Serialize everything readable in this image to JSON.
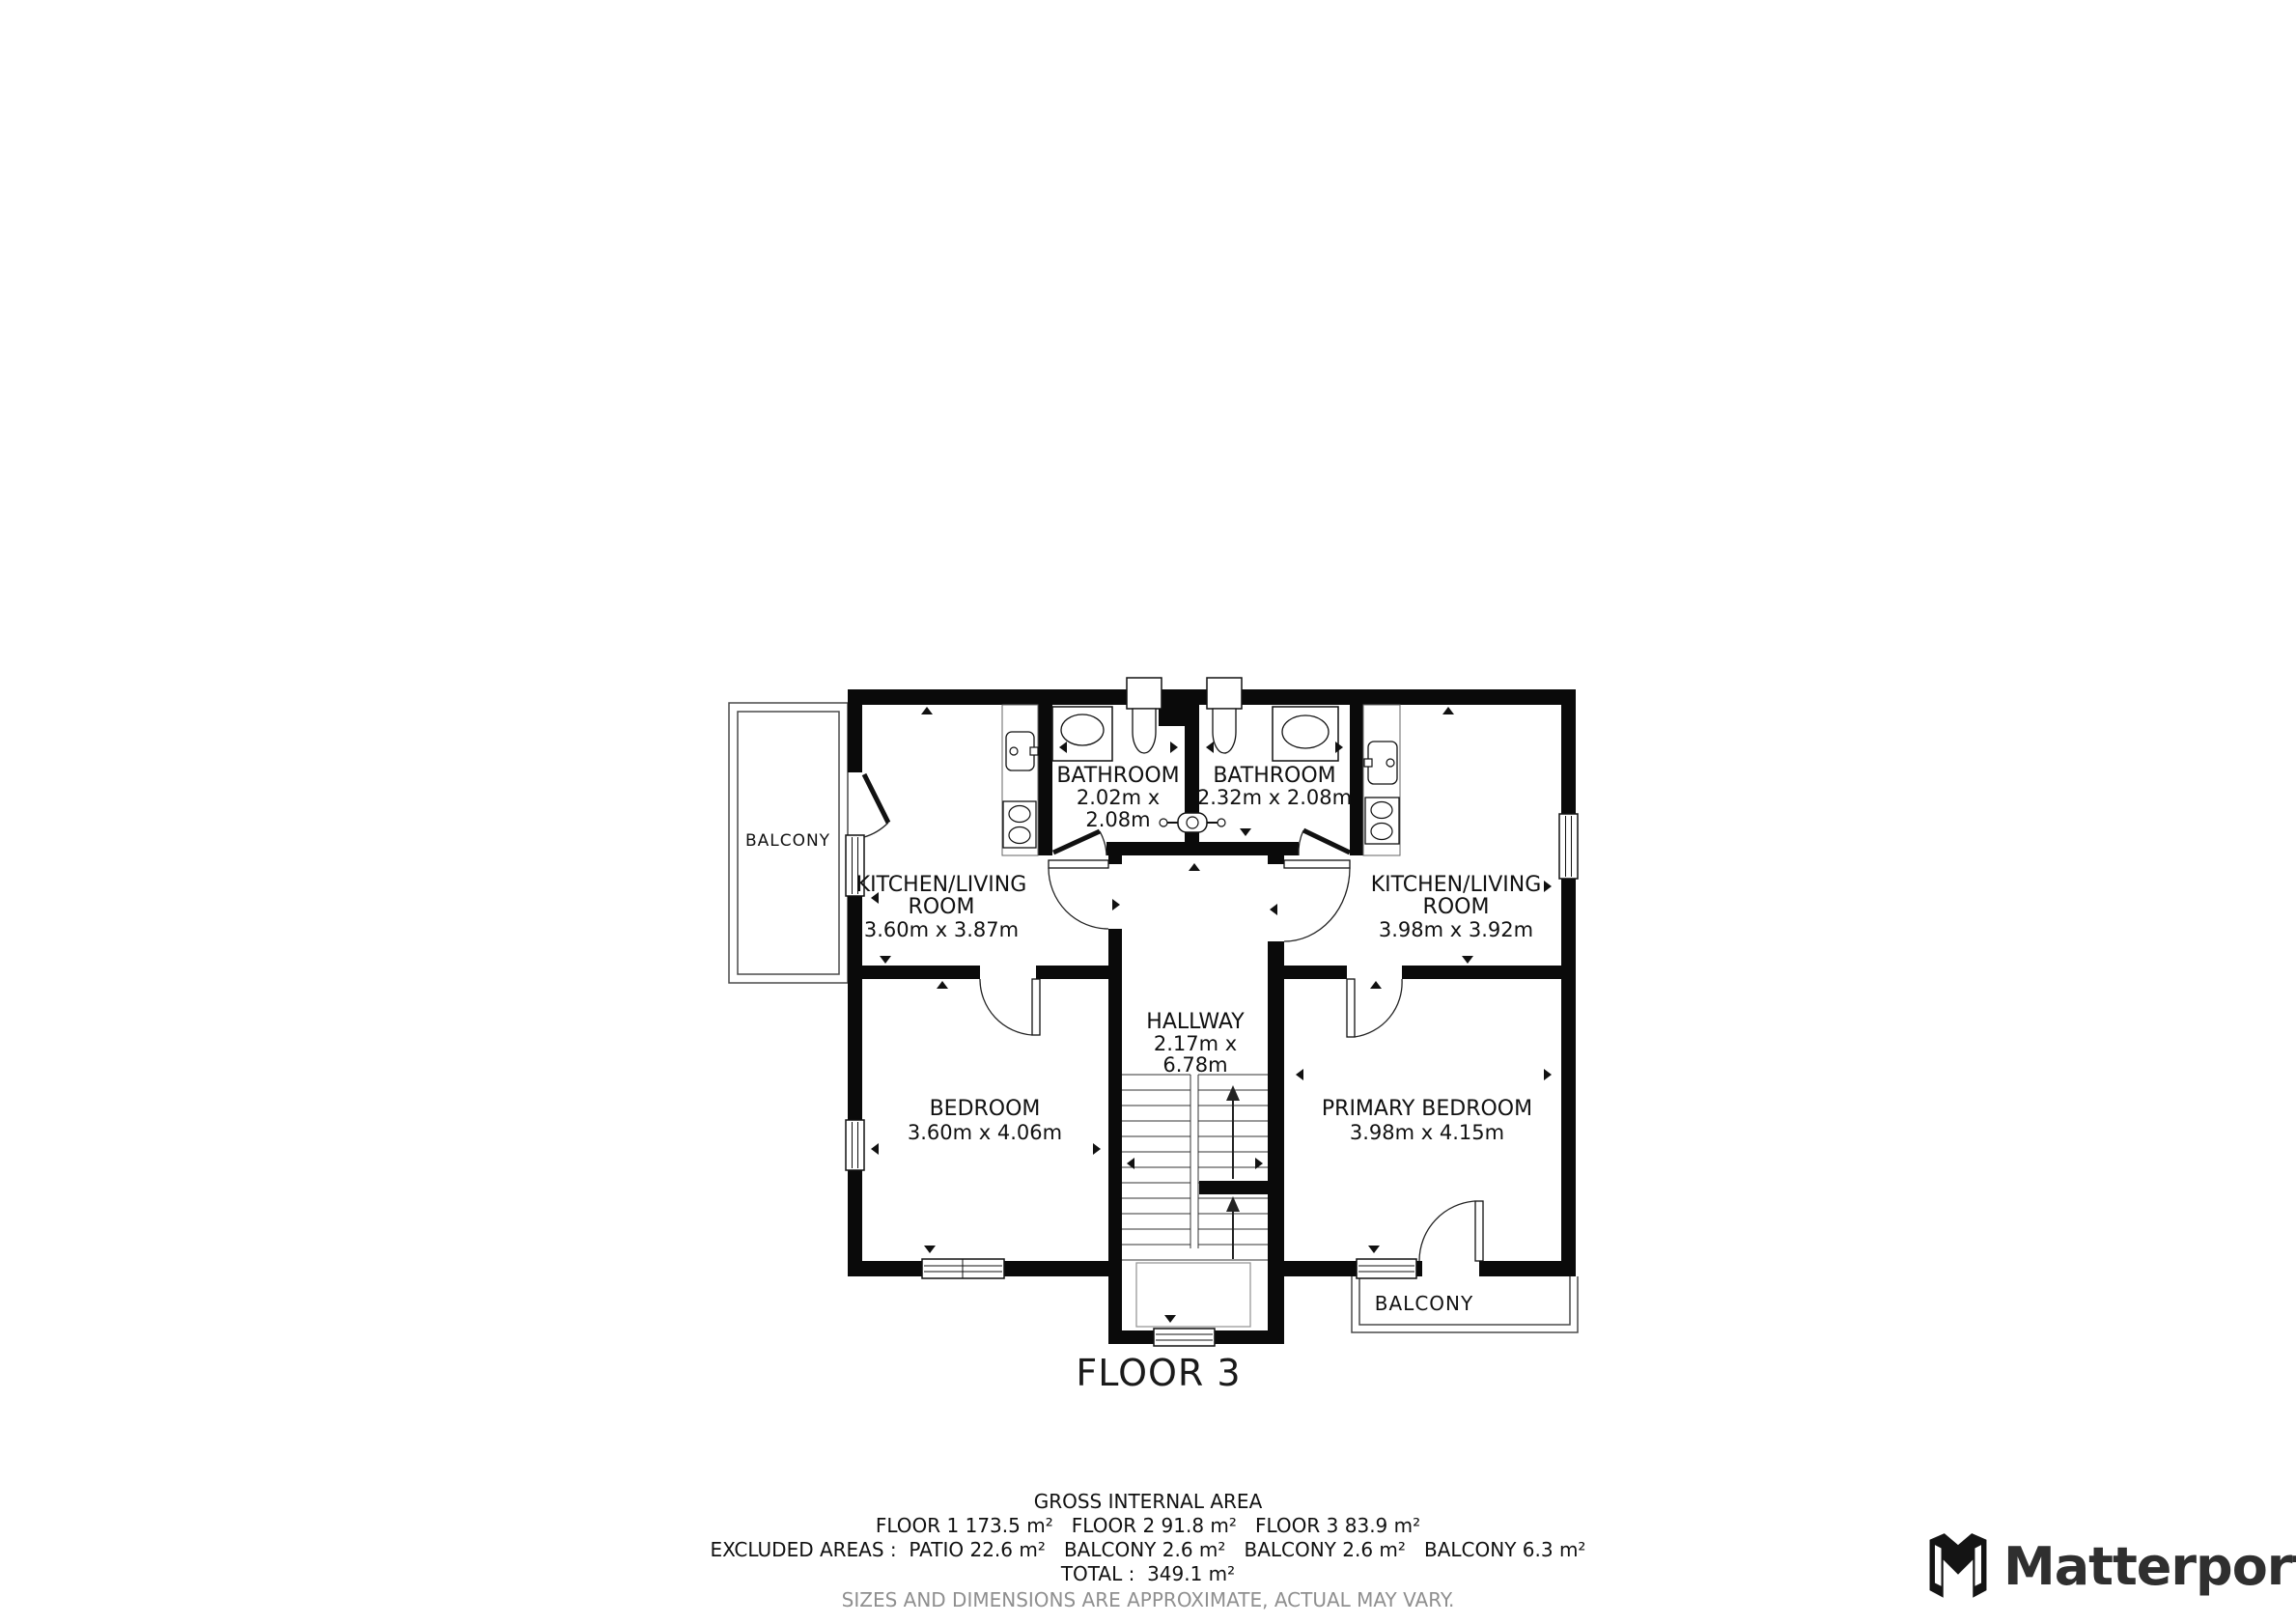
{
  "plan": {
    "floor_title": "FLOOR 3",
    "rooms": {
      "bathroom1": {
        "name": "BATHROOM",
        "dims1": "2.02m x",
        "dims2": "2.08m"
      },
      "bathroom2": {
        "name": "BATHROOM",
        "dims1": "2.32m x 2.08m"
      },
      "kitchen_left": {
        "name1": "KITCHEN/LIVING",
        "name2": "ROOM",
        "dims": "3.60m x 3.87m"
      },
      "kitchen_right": {
        "name1": "KITCHEN/LIVING",
        "name2": "ROOM",
        "dims": "3.98m x 3.92m"
      },
      "hallway": {
        "name": "HALLWAY",
        "dims1": "2.17m x",
        "dims2": "6.78m"
      },
      "bedroom": {
        "name": "BEDROOM",
        "dims": "3.60m x 4.06m"
      },
      "primary_bedroom": {
        "name": "PRIMARY BEDROOM",
        "dims": "3.98m x 4.15m"
      },
      "balcony_left": {
        "name": "BALCONY"
      },
      "balcony_bottom": {
        "name": "BALCONY"
      }
    },
    "colors": {
      "wall": "#0a0a0a",
      "balcony_line": "#4a4a4a",
      "disclaimer_gray": "#8f8f8f"
    }
  },
  "footer": {
    "title": "GROSS INTERNAL AREA",
    "floors_line": "FLOOR 1 173.5 m²   FLOOR 2 91.8 m²   FLOOR 3 83.9 m²",
    "excluded_line": "EXCLUDED AREAS :  PATIO 22.6 m²   BALCONY 2.6 m²   BALCONY 2.6 m²   BALCONY 6.3 m²",
    "total_line": "TOTAL :  349.1 m²",
    "disclaimer": "SIZES AND DIMENSIONS ARE APPROXIMATE, ACTUAL MAY VARY."
  },
  "logo": {
    "text": "Matterport"
  }
}
